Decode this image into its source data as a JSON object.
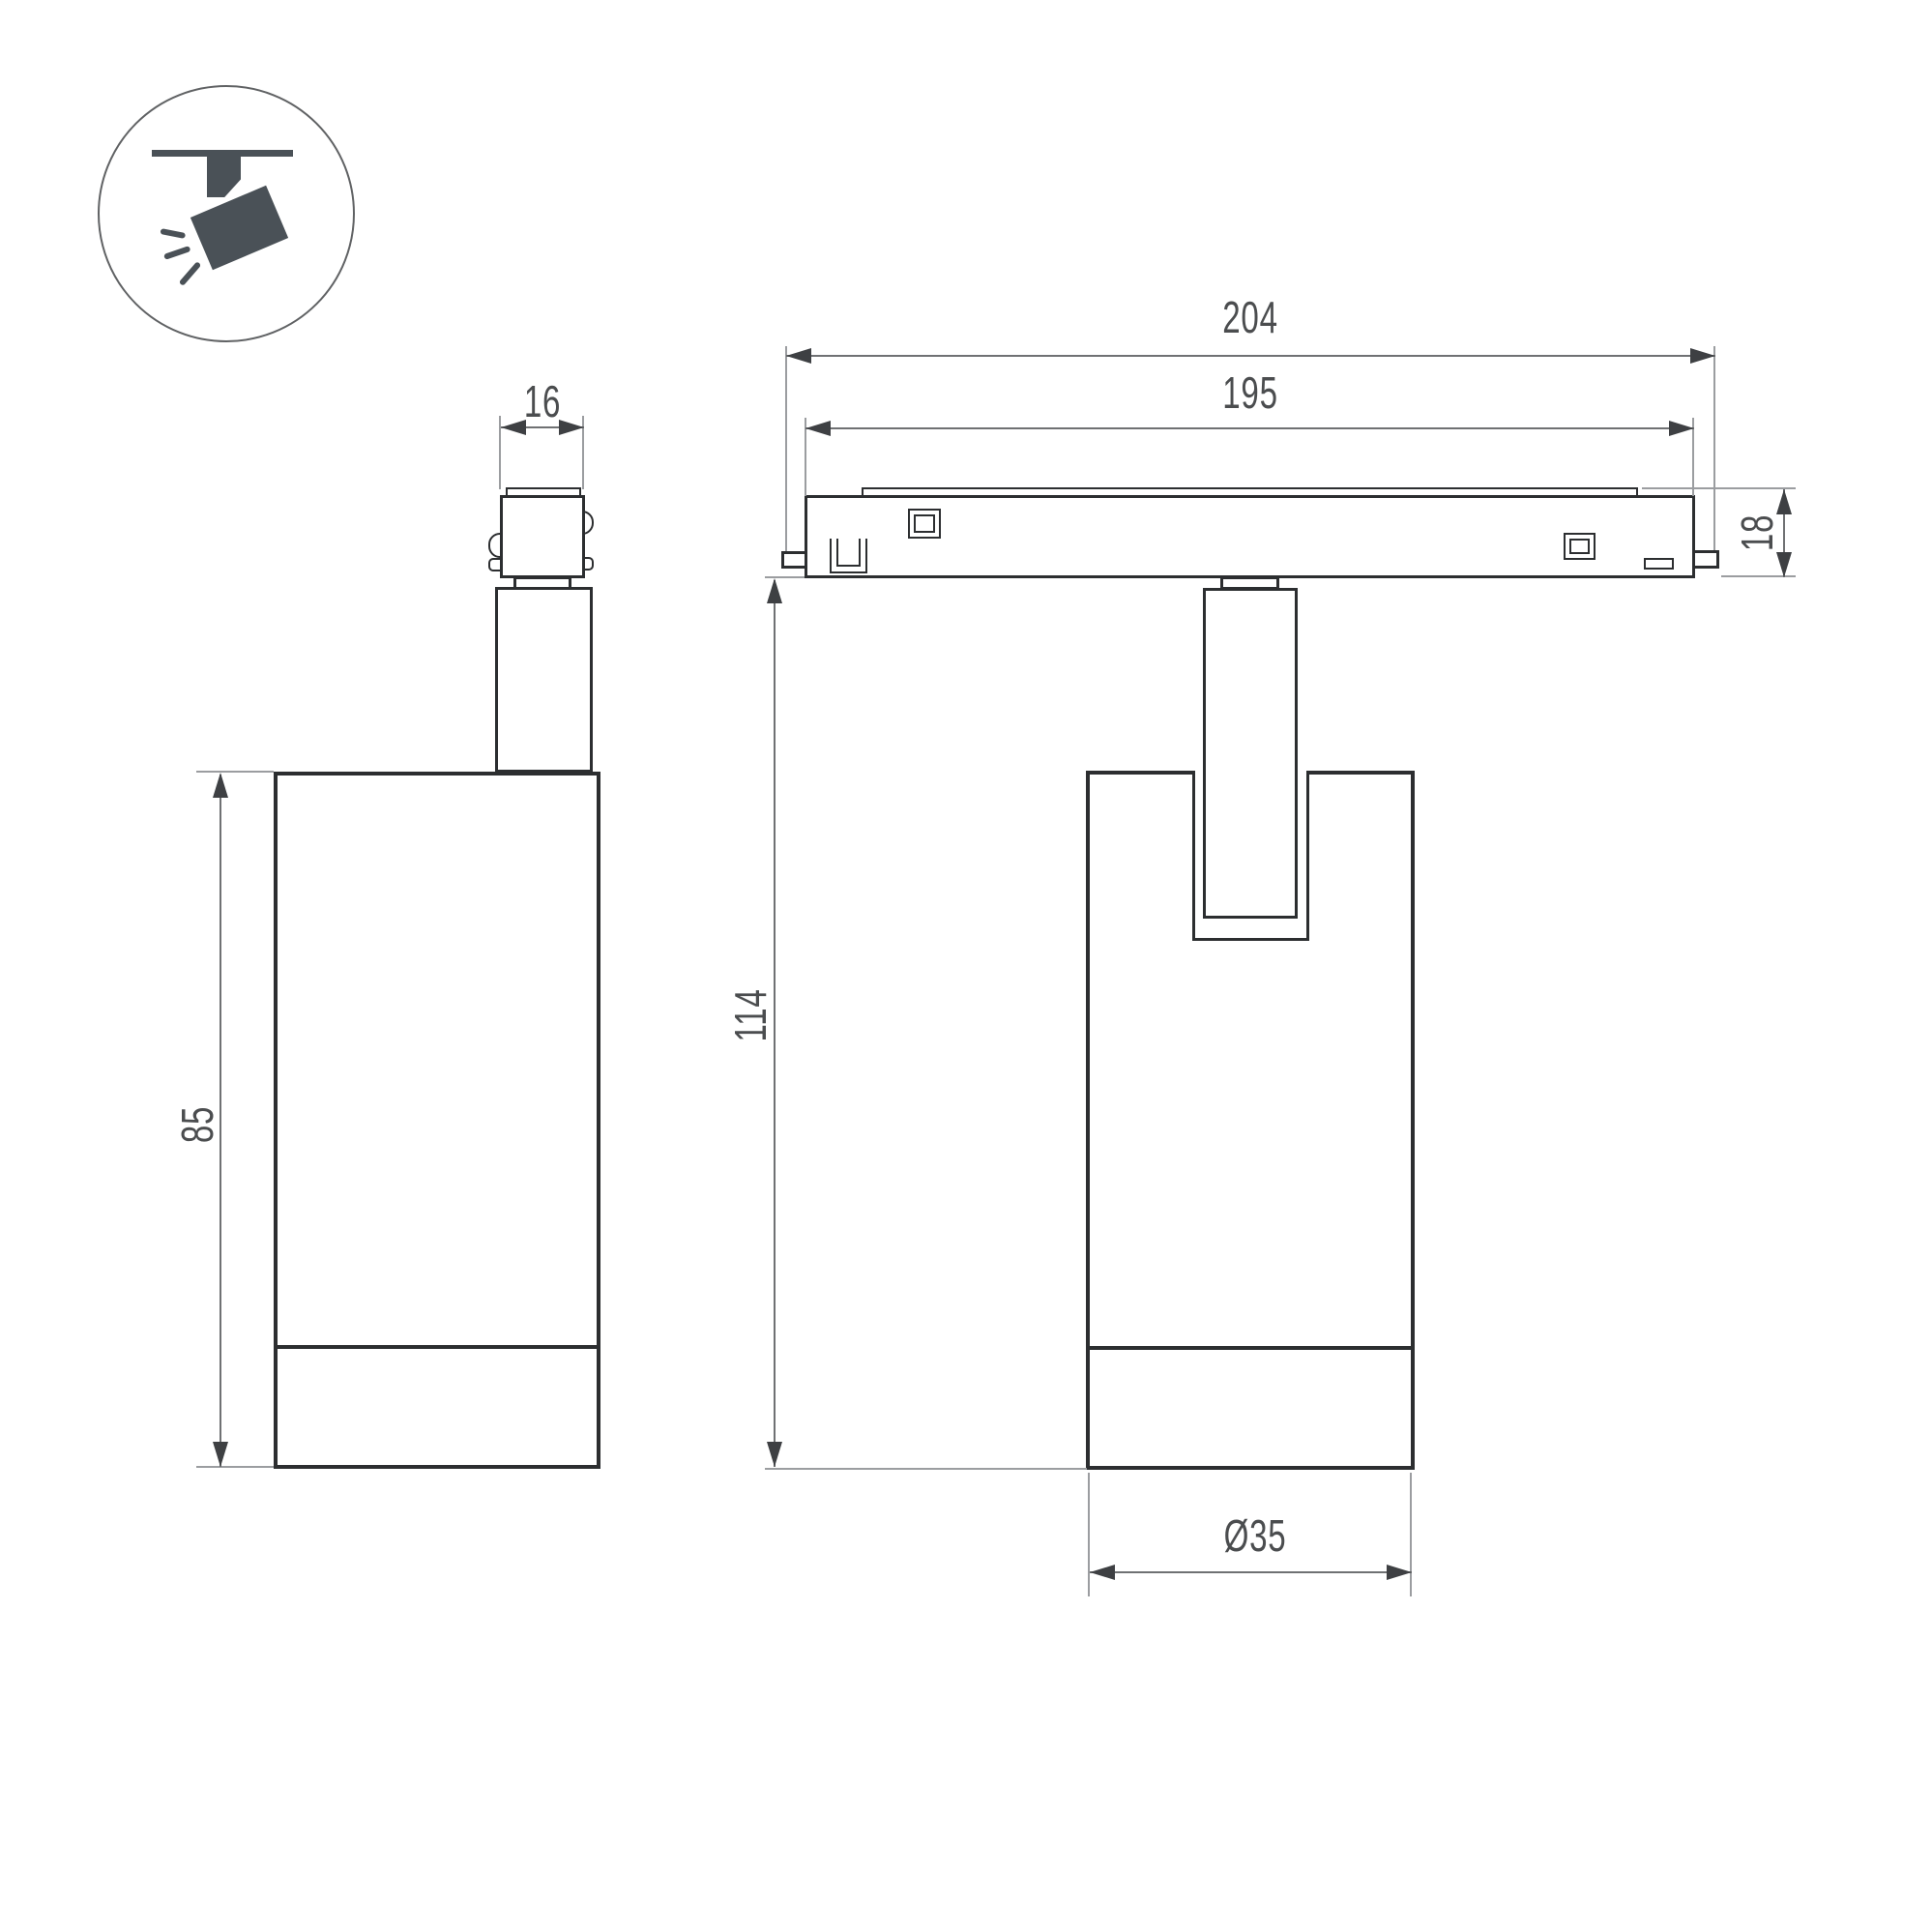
{
  "icon": {
    "name": "ceiling-track-spotlight-icon"
  },
  "dimensions": {
    "track_length_total": "204",
    "track_length_body": "195",
    "adapter_width": "16",
    "track_height": "18",
    "overall_height": "114",
    "body_height": "85",
    "body_diameter": "Ø35"
  },
  "colors": {
    "background": "#ffffff",
    "outline": "#2c2e30",
    "dimension": "#6f7173",
    "extension": "#9b9da0",
    "arrow": "#3e4043",
    "text": "#4b4d4f",
    "icon": "#4a5157",
    "circle": "#606264"
  }
}
